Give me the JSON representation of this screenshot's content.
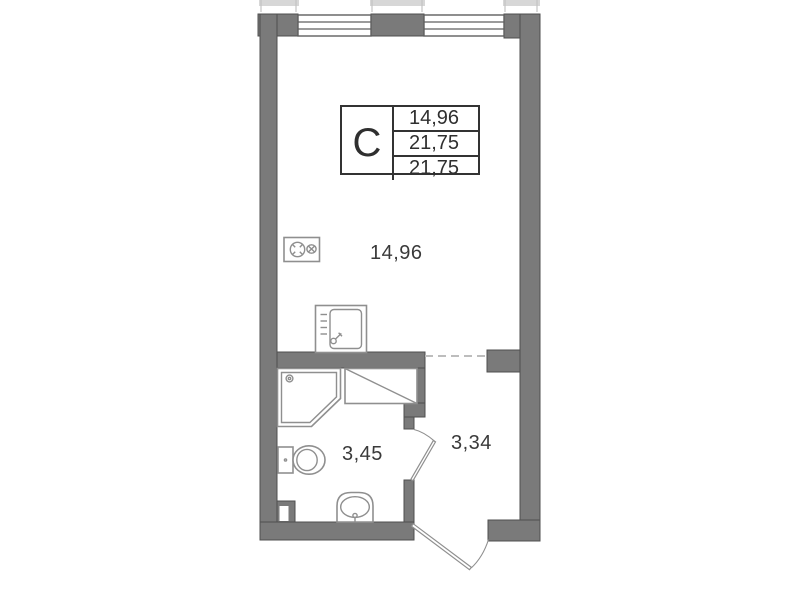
{
  "title": "studio-floor-plan",
  "colors": {
    "wall_fill": "#7a7a7a",
    "wall_edge": "#4f4f4f",
    "fixture_line": "#8f8f8f",
    "window_line": "#5f5f5f",
    "dash_line": "#bdbdbd",
    "text": "#3a3a3a",
    "table_border": "#333333",
    "background": "#ffffff"
  },
  "unit_card": {
    "type_label": "С",
    "values": [
      "14,96",
      "21,75",
      "21,75"
    ]
  },
  "room_areas": {
    "living": "14,96",
    "bathroom": "3,45",
    "hallway": "3,34"
  },
  "fixtures": [
    "window-icon",
    "stove-icon",
    "kitchen-sink-icon",
    "counter-icon",
    "shower-icon",
    "toilet-icon",
    "washbasin-icon",
    "duct-shaft-icon",
    "bathroom-door-icon",
    "entrance-door-icon"
  ]
}
